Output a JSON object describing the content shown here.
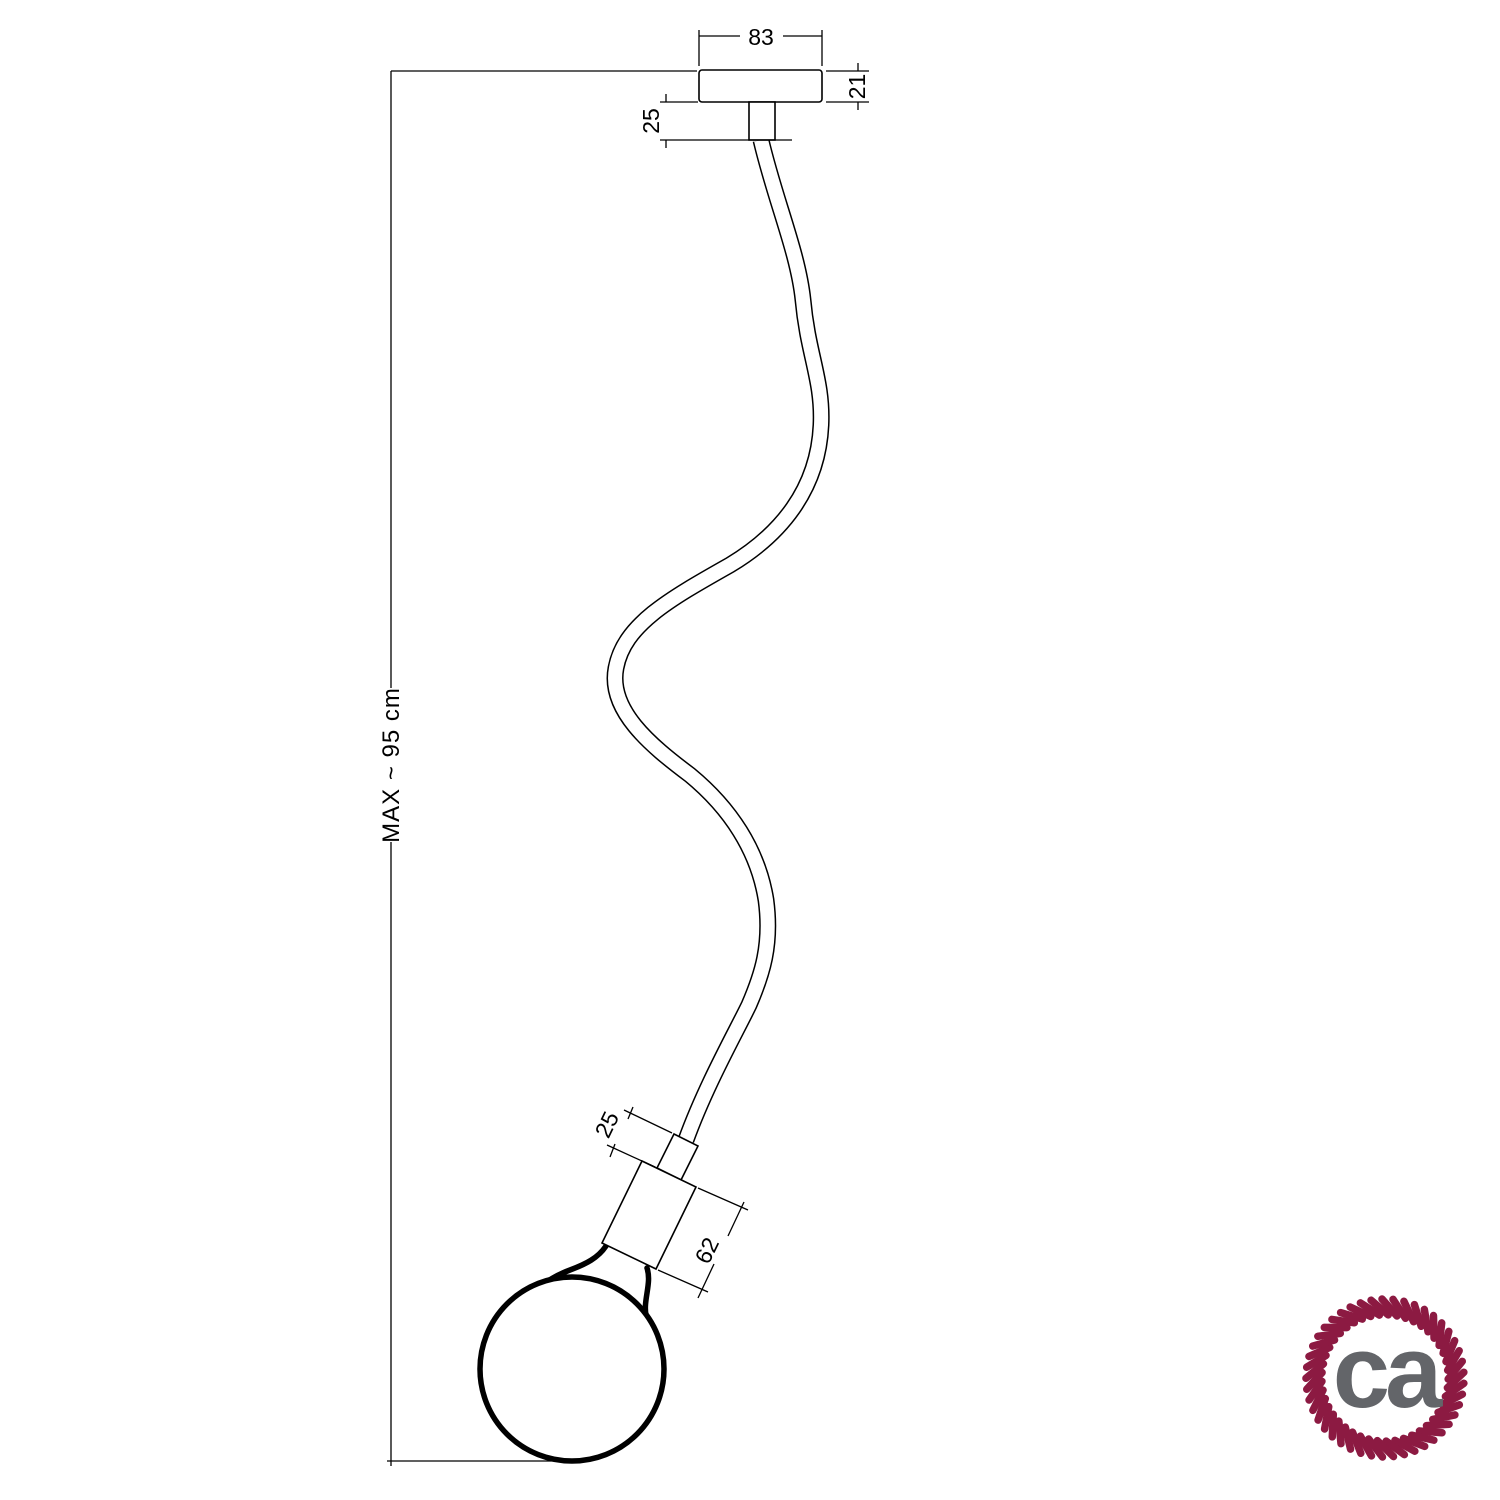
{
  "page": {
    "background": "#ffffff",
    "line_color": "#000000"
  },
  "drawing": {
    "type": "pendant-lamp-dimension-drawing",
    "dimensions": {
      "canopy_width": "83",
      "canopy_height": "21",
      "top_cable_clamp_length": "25",
      "max_length": "MAX ~ 95 cm",
      "socket_cable_clamp_length": "25",
      "socket_length": "62"
    }
  },
  "logo": {
    "text": "ca",
    "ring_color": "#8c1a42",
    "text_color": "#636569"
  }
}
